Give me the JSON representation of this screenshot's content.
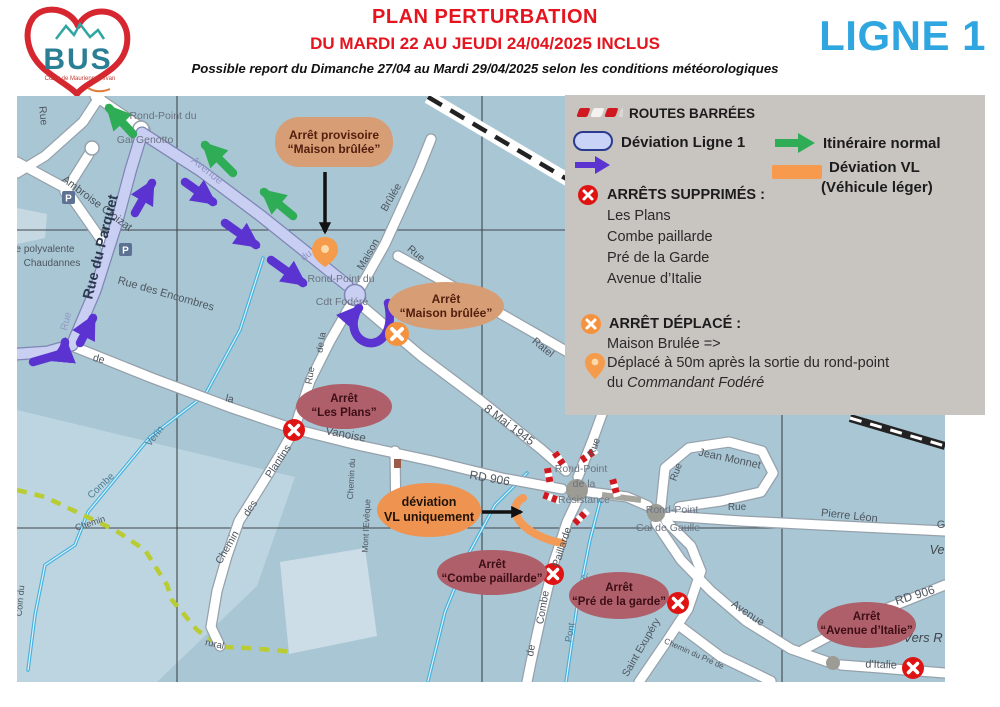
{
  "header": {
    "title": "PLAN PERTURBATION",
    "subtitle": "DU MARDI 22 AU JEUDI 24/04/2025 INCLUS",
    "note": "Possible report du Dimanche 27/04 au Mardi 29/04/2025 selon les conditions météorologiques",
    "line_badge": "LIGNE 1",
    "logo": {
      "text": "BUS",
      "subtext": "Cœur de Maurienne Arvan"
    }
  },
  "legend": {
    "routes_barrees": "ROUTES BARRÉES",
    "deviation_ligne1": "Déviation Ligne 1",
    "itineraire_normal": "Itinéraire normal",
    "deviation_vl": "Déviation VL",
    "deviation_vl_sub": "(Véhicule léger)",
    "arrets_supprimes_title": "ARRÊTS SUPPRIMÉS :",
    "arrets_supprimes": [
      "Les Plans",
      "Combe paillarde",
      "Pré de la Garde",
      "Avenue d’Italie"
    ],
    "arret_deplace_title": "ARRÊT DÉPLACÉ :",
    "arret_deplace_from": "Maison Brulée =>",
    "deplace_line1": "Déplacé à 50m après la sortie du rond-point",
    "deplace_line2_prefix": "du ",
    "deplace_line2_italic": "Commandant Fodéré"
  },
  "map": {
    "colors": {
      "deviation_purple": "#5b33d0",
      "normal_green": "#2fad56",
      "vl_orange": "#f39a57",
      "closed_red": "#e01313",
      "moved_orange": "#f5923e",
      "route_lavender": "#c9cff3"
    },
    "callouts": {
      "provisoire": {
        "line1": "Arrêt provisoire",
        "line2": "“Maison brûlée”"
      },
      "maison_brulee": {
        "line1": "Arrêt",
        "line2": "“Maison brûlée”"
      },
      "les_plans": {
        "line1": "Arrêt",
        "line2": "“Les Plans”"
      },
      "deviation_vl": {
        "line1": "déviation",
        "line2": "VL uniquement"
      },
      "combe_paillarde": {
        "line1": "Arrêt",
        "line2": "“Combe paillarde”"
      },
      "pre_garde": {
        "line1": "Arrêt",
        "line2": "“Pré de la garde”"
      },
      "avenue_italie": {
        "line1": "Arrêt",
        "line2": "“Avenue d’Italie”"
      }
    },
    "street_labels": [
      {
        "t": "Rue",
        "x": 23,
        "y": 20,
        "r": 85,
        "s": 10.5
      },
      {
        "t": "Ambroise Croizat",
        "x": 78,
        "y": 110,
        "r": 37,
        "s": 11
      },
      {
        "t": "Rond-Point du",
        "x": 146,
        "y": 23,
        "s": 10.5,
        "c": "#6b7280"
      },
      {
        "t": "Gal Genotto",
        "x": 128,
        "y": 47,
        "s": 10.5,
        "c": "#6b7280"
      },
      {
        "t": "Avenue",
        "x": 188,
        "y": 77,
        "r": 39,
        "c": "#9199c4",
        "s": 11
      },
      {
        "t": "Rue du Parquet",
        "x": 88,
        "y": 152,
        "r": -76,
        "s": 14.5,
        "w": 700,
        "c": "#2c3850"
      },
      {
        "t": "Rue",
        "x": 52,
        "y": 226,
        "r": -75,
        "c": "#9199c4",
        "s": 10
      },
      {
        "t": "e polyvalente",
        "x": 28,
        "y": 156,
        "s": 10
      },
      {
        "t": "Chaudannes",
        "x": 35,
        "y": 170,
        "s": 10
      },
      {
        "t": "Rue des Encombres",
        "x": 148,
        "y": 201,
        "r": 16,
        "s": 11
      },
      {
        "t": "de",
        "x": 81,
        "y": 266,
        "r": 15,
        "s": 10.5
      },
      {
        "t": "la",
        "x": 212,
        "y": 306,
        "r": 13,
        "s": 10.5
      },
      {
        "t": "Vanoise",
        "x": 328,
        "y": 342,
        "r": 11,
        "s": 11.5
      },
      {
        "t": "Verin",
        "x": 140,
        "y": 342,
        "r": -52,
        "c": "#4a7c95",
        "s": 10
      },
      {
        "t": "Combe",
        "x": 86,
        "y": 392,
        "r": -43,
        "c": "#4a7c95",
        "s": 10
      },
      {
        "t": "Chemin",
        "x": 74,
        "y": 430,
        "r": -18,
        "s": 9
      },
      {
        "t": "Coin du",
        "x": 6,
        "y": 505,
        "r": -85,
        "s": 9
      },
      {
        "t": "rural",
        "x": 197,
        "y": 551,
        "r": 12,
        "s": 9.5
      },
      {
        "t": "Plantins",
        "x": 264,
        "y": 367,
        "r": -56,
        "s": 10.5
      },
      {
        "t": "des",
        "x": 236,
        "y": 414,
        "r": -56,
        "s": 10.5
      },
      {
        "t": "Chemin",
        "x": 213,
        "y": 453,
        "r": -60,
        "s": 10.5
      },
      {
        "t": "Chemin du",
        "x": 337,
        "y": 383,
        "r": -87,
        "s": 8.5
      },
      {
        "t": "Mont l'Evêque",
        "x": 352,
        "y": 430,
        "r": -87,
        "s": 8.5
      },
      {
        "t": "Rond-Point du",
        "x": 324,
        "y": 186,
        "s": 10.5,
        "c": "#6b7280"
      },
      {
        "t": "Cdt Fodéré",
        "x": 325,
        "y": 209,
        "s": 10.5,
        "c": "#6b7280"
      },
      {
        "t": "du",
        "x": 291,
        "y": 162,
        "r": -38,
        "c": "#9199c4",
        "s": 10
      },
      {
        "t": "de la",
        "x": 307,
        "y": 247,
        "r": -80,
        "s": 9.5
      },
      {
        "t": "Rue",
        "x": 296,
        "y": 280,
        "r": -80,
        "s": 9.5
      },
      {
        "t": "Maison",
        "x": 354,
        "y": 160,
        "r": -60,
        "s": 10.5
      },
      {
        "t": "Brûlée",
        "x": 377,
        "y": 103,
        "r": -60,
        "s": 10.5
      },
      {
        "t": "Rue",
        "x": 397,
        "y": 160,
        "r": 40,
        "s": 10.5
      },
      {
        "t": "Clement",
        "x": 457,
        "y": 207,
        "r": 39,
        "s": 10.5
      },
      {
        "t": "Ratel",
        "x": 524,
        "y": 254,
        "r": 39,
        "s": 10.5
      },
      {
        "t": "8 Mai 1945",
        "x": 490,
        "y": 332,
        "r": 37,
        "s": 12
      },
      {
        "t": "RD 906",
        "x": 472,
        "y": 386,
        "r": 10,
        "s": 12
      },
      {
        "t": "Rue",
        "x": 580,
        "y": 352,
        "r": -70,
        "s": 10
      },
      {
        "t": "Rond-Point",
        "x": 564,
        "y": 376,
        "s": 10.5,
        "c": "#6b7280"
      },
      {
        "t": "de la",
        "x": 567,
        "y": 391,
        "s": 10.5,
        "c": "#6b7280"
      },
      {
        "t": "Résistance",
        "x": 567,
        "y": 407,
        "s": 10.5,
        "c": "#6b7280"
      },
      {
        "t": "Rond-Point",
        "x": 655,
        "y": 417,
        "s": 10.5,
        "c": "#6b7280"
      },
      {
        "t": "Gal de Gaulle",
        "x": 651,
        "y": 435,
        "s": 10.5,
        "c": "#6b7280"
      },
      {
        "t": "Jean Monnet",
        "x": 712,
        "y": 366,
        "r": 12,
        "s": 11
      },
      {
        "t": "Rue",
        "x": 662,
        "y": 377,
        "r": -70,
        "s": 10
      },
      {
        "t": "Rue",
        "x": 720,
        "y": 414,
        "s": 10
      },
      {
        "t": "Pierre Léon",
        "x": 832,
        "y": 423,
        "r": 6,
        "s": 11
      },
      {
        "t": "G",
        "x": 924,
        "y": 432,
        "s": 11
      },
      {
        "t": "Ve",
        "x": 920,
        "y": 458,
        "s": 12.5,
        "i": 1,
        "c": "#3f474d"
      },
      {
        "t": "Paillarde",
        "x": 548,
        "y": 452,
        "r": -72,
        "s": 10.5
      },
      {
        "t": "Combe",
        "x": 529,
        "y": 512,
        "r": -80,
        "s": 10.5
      },
      {
        "t": "de",
        "x": 517,
        "y": 555,
        "r": -80,
        "s": 10.5
      },
      {
        "t": "Sec.",
        "x": 569,
        "y": 486,
        "r": -75,
        "c": "#4a7c95",
        "s": 9.5
      },
      {
        "t": "Pont",
        "x": 556,
        "y": 537,
        "r": -80,
        "c": "#4a7c95",
        "s": 9.5
      },
      {
        "t": "Saint Exupéry",
        "x": 627,
        "y": 553,
        "r": -60,
        "s": 10.5
      },
      {
        "t": "Chemin du Pré de",
        "x": 676,
        "y": 560,
        "r": 24,
        "s": 8
      },
      {
        "t": "Avenue",
        "x": 729,
        "y": 520,
        "r": 34,
        "s": 11
      },
      {
        "t": "RD 906",
        "x": 899,
        "y": 503,
        "r": -17,
        "s": 12
      },
      {
        "t": "Vers R",
        "x": 906,
        "y": 546,
        "s": 13,
        "i": 1,
        "c": "#3f474d"
      },
      {
        "t": "d'Italie",
        "x": 864,
        "y": 572,
        "r": 2,
        "s": 11
      }
    ]
  }
}
